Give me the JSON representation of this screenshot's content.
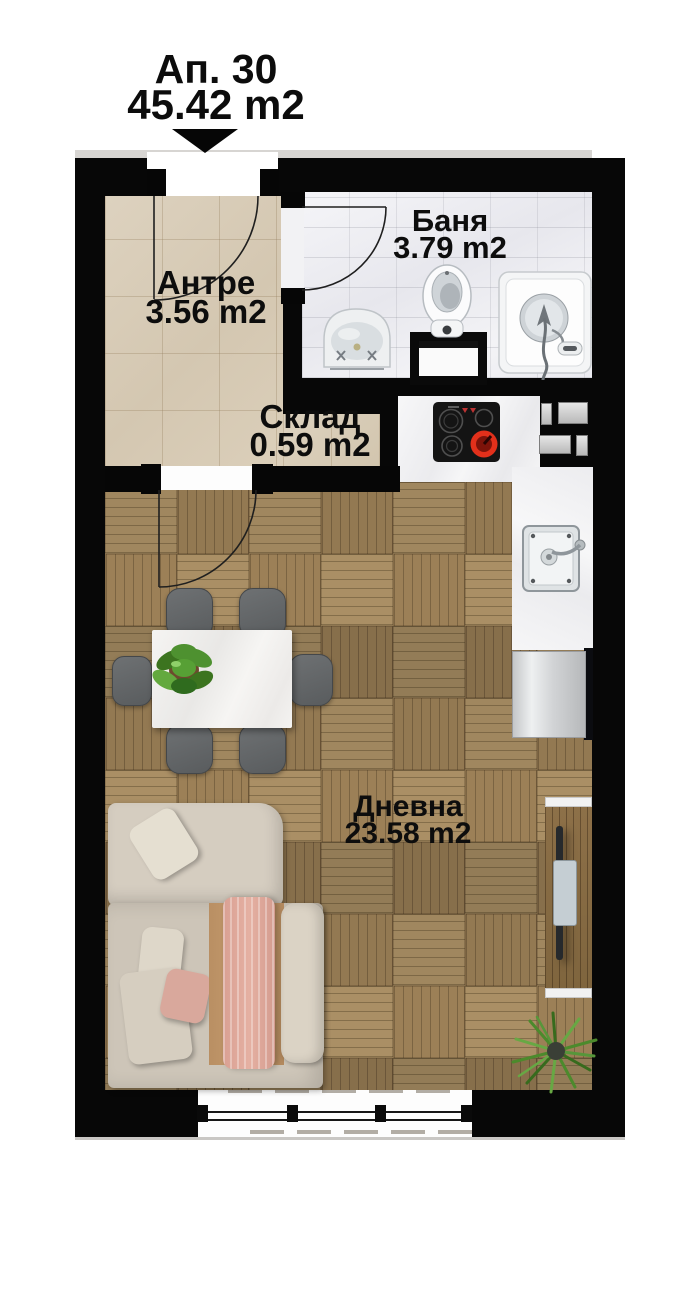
{
  "title": {
    "apartment": "Ап. 30",
    "area": "45.42 m2"
  },
  "rooms": {
    "antre": {
      "name": "Антре",
      "area": "3.56 m2"
    },
    "banya": {
      "name": "Баня",
      "area": "3.79 m2"
    },
    "sklad": {
      "name": "Склад",
      "area": "0.59 m2"
    },
    "dnevna": {
      "name": "Дневна",
      "area": "23.58 m2"
    }
  },
  "colors": {
    "wall": "#070707",
    "entrance_tile": "#d9cdb9",
    "bathroom_tile": "#f0f0f3",
    "parquet": "#97805d",
    "counter_marble": "#f5f5f6",
    "burner_red": "#e2301b",
    "sofa_beige": "#d2cabd",
    "blanket_tan": "#bf9669",
    "throw_pink": "#dfa79a",
    "tv_wood": "#8a6c46",
    "chair_gray": "#64676a",
    "plant_green": "#4c8a2c"
  }
}
